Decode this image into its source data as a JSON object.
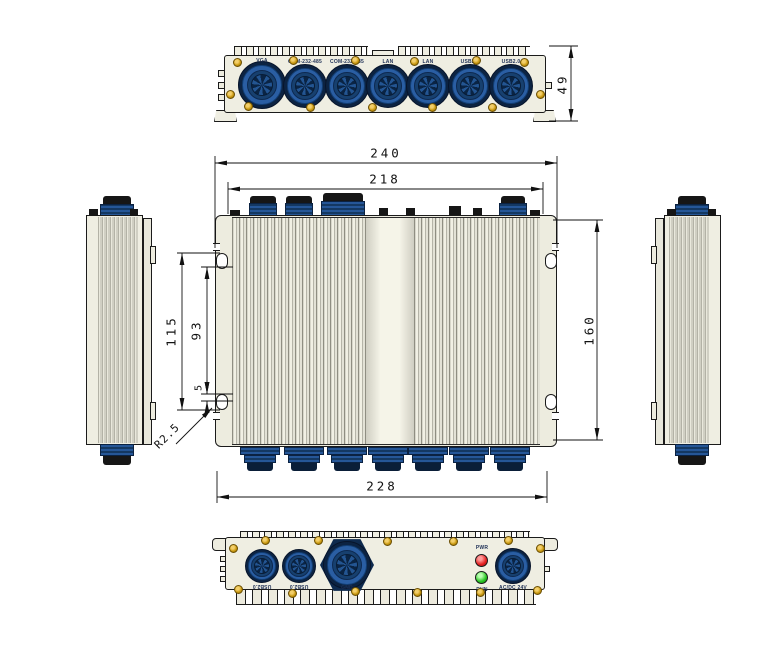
{
  "top_view": {
    "connector_labels": [
      "VGA",
      "COM-232-485",
      "COM-232-485",
      "LAN",
      "LAN",
      "USB2.0",
      "USB2.0"
    ],
    "height_dim": "49"
  },
  "front_view": {
    "dims": {
      "overall_width": "240",
      "upper_width": "218",
      "lower_width": "228",
      "height": "160",
      "slot_span_outer": "115",
      "slot_span_inner": "93",
      "slot_offset": "5",
      "corner_radius": "R2.5"
    }
  },
  "bottom_view": {
    "connector_labels": [
      "USB2.0",
      "USB2.0",
      "GND",
      "AC/DC 24V"
    ],
    "led_labels": {
      "top": "PWR",
      "bottom": "RUN"
    }
  },
  "colors": {
    "body_ivory": "#efeee2",
    "outline": "#1b1b1b",
    "connector_blue": "#2a5ea3",
    "connector_navy": "#0c2342",
    "screw_gold": "#c9980f",
    "led_red": "#e31f1f",
    "led_green": "#27c422"
  }
}
